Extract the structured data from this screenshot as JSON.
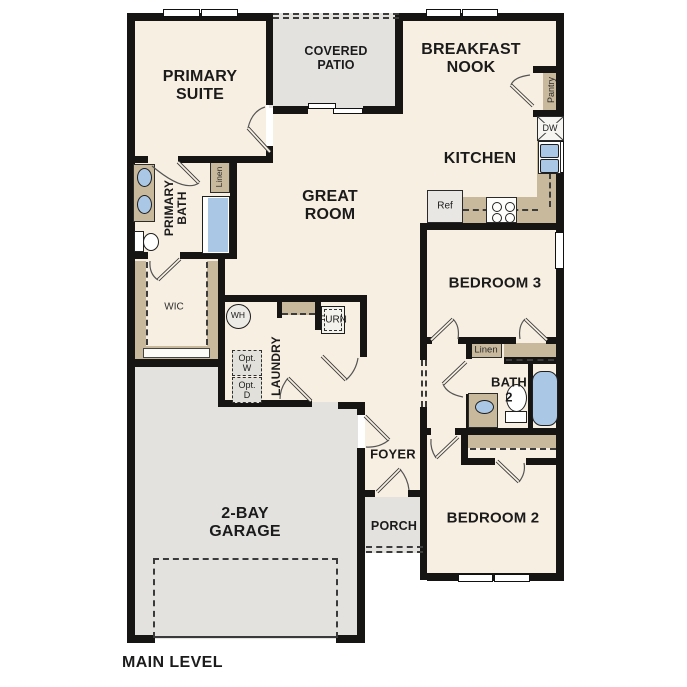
{
  "footer": {
    "level_label": "MAIN LEVEL"
  },
  "rooms": {
    "primary_suite": {
      "label": "PRIMARY\nSUITE"
    },
    "covered_patio": {
      "label": "COVERED\nPATIO"
    },
    "breakfast_nook": {
      "label": "BREAKFAST\nNOOK"
    },
    "kitchen": {
      "label": "KITCHEN"
    },
    "great_room": {
      "label": "GREAT\nROOM"
    },
    "primary_bath": {
      "label": "PRIMARY\nBATH"
    },
    "wic": {
      "label": "WIC"
    },
    "laundry": {
      "label": "LAUNDRY"
    },
    "bedroom_3": {
      "label": "BEDROOM 3"
    },
    "bath_2": {
      "label": "BATH\n2"
    },
    "bedroom_2": {
      "label": "BEDROOM 2"
    },
    "foyer": {
      "label": "FOYER"
    },
    "porch": {
      "label": "PORCH"
    },
    "garage": {
      "label": "2-BAY\nGARAGE"
    }
  },
  "fixtures": {
    "linen_primary": "Linen",
    "linen_hall": "Linen",
    "pantry": "Pantry",
    "dishwasher": "DW",
    "refrigerator": "Ref",
    "water_heater": "WH",
    "furnace": "FURN",
    "optional_washer": "Opt.\nW",
    "optional_dryer": "Opt.\nD"
  },
  "colors": {
    "wall": "#171513",
    "floor": "#f7efe2",
    "outdoor_zone": "#e3e2df",
    "cabinetry": "#c8b99c",
    "plumbing_blue": "#aac8e6",
    "dashed_line": "#3c3c3c"
  }
}
